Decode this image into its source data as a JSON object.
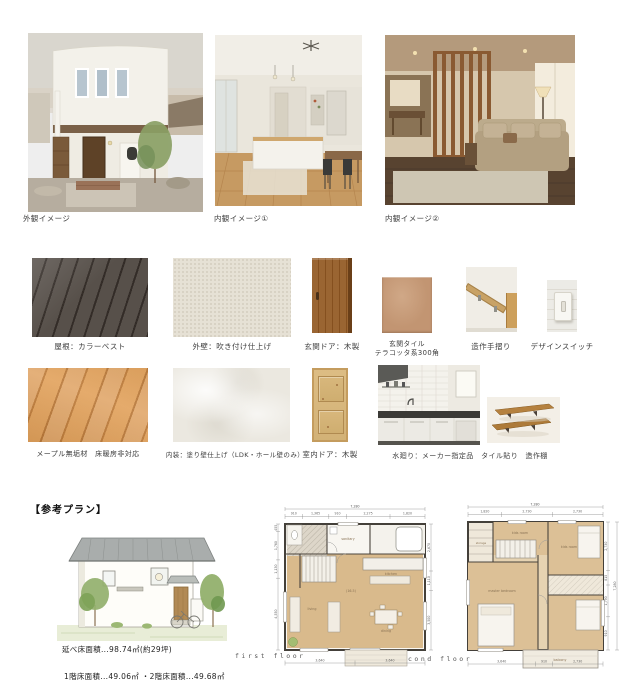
{
  "photos": {
    "exterior_label": "外観イメージ",
    "interior1_label": "内観イメージ①",
    "interior2_label": "内観イメージ②"
  },
  "materials": {
    "roof": "屋根：カラーベスト",
    "outer_wall": "外壁：吹き付け仕上げ",
    "entrance_door": "玄関ドア：木製",
    "entrance_tile_1": "玄関タイル",
    "entrance_tile_2": "テラコッタ系300角",
    "handrail": "造作手摺り",
    "switch": "デザインスイッチ",
    "maple_floor": "メープル無垢材　床暖房非対応",
    "interior_wall": "内装：塗り壁仕上げ（LDK・ホール壁のみ）",
    "interior_door": "室内ドア：木製",
    "water_area": "水廻り：メーカー指定品　タイル貼り　造作棚"
  },
  "plan": {
    "heading": "【参考プラン】",
    "total_area": "延べ床面積...98.74㎡(約29坪)",
    "floor_areas": "1階床面積...49.06㎡ ・2階床面積...49.68㎡",
    "first_floor": {
      "label": "first floor",
      "dim_top_total": "7,280",
      "dims_top": [
        "910",
        "1,365",
        "910",
        "2,275",
        "1,820"
      ],
      "dims_left": [
        "455",
        "1,760",
        "1,130",
        "4,550"
      ],
      "dims_right": [
        "2,670",
        "1,110",
        "3,500"
      ],
      "dims_bottom": [
        "3,640",
        "3,640"
      ],
      "rooms": {
        "living": "living",
        "dining": "dining",
        "kitchen": "kitchen",
        "sanitary": "sanitary",
        "ldk_size": "(16.5)"
      }
    },
    "second_floor": {
      "label": "cond floor",
      "dim_top_total": "7,280",
      "dims_top": [
        "1,820",
        "2,730",
        "2,730"
      ],
      "dims_right": [
        "2,730",
        "815",
        "1,790",
        "910"
      ],
      "dim_right_total": "7,280",
      "dims_bottom": [
        "3,640",
        "910",
        "2,730"
      ],
      "rooms": {
        "storage": "storage",
        "kids1": "kids room",
        "kids2": "kids room",
        "master": "master bedroom",
        "balcony": "balcony"
      }
    }
  },
  "colors": {
    "wood_accent": "#9a6532",
    "terracotta_tile": "#c29572",
    "roof_dark": "#57504a",
    "plan_room_tan": "#d9ba8c",
    "page_bg": "#ffffff"
  }
}
